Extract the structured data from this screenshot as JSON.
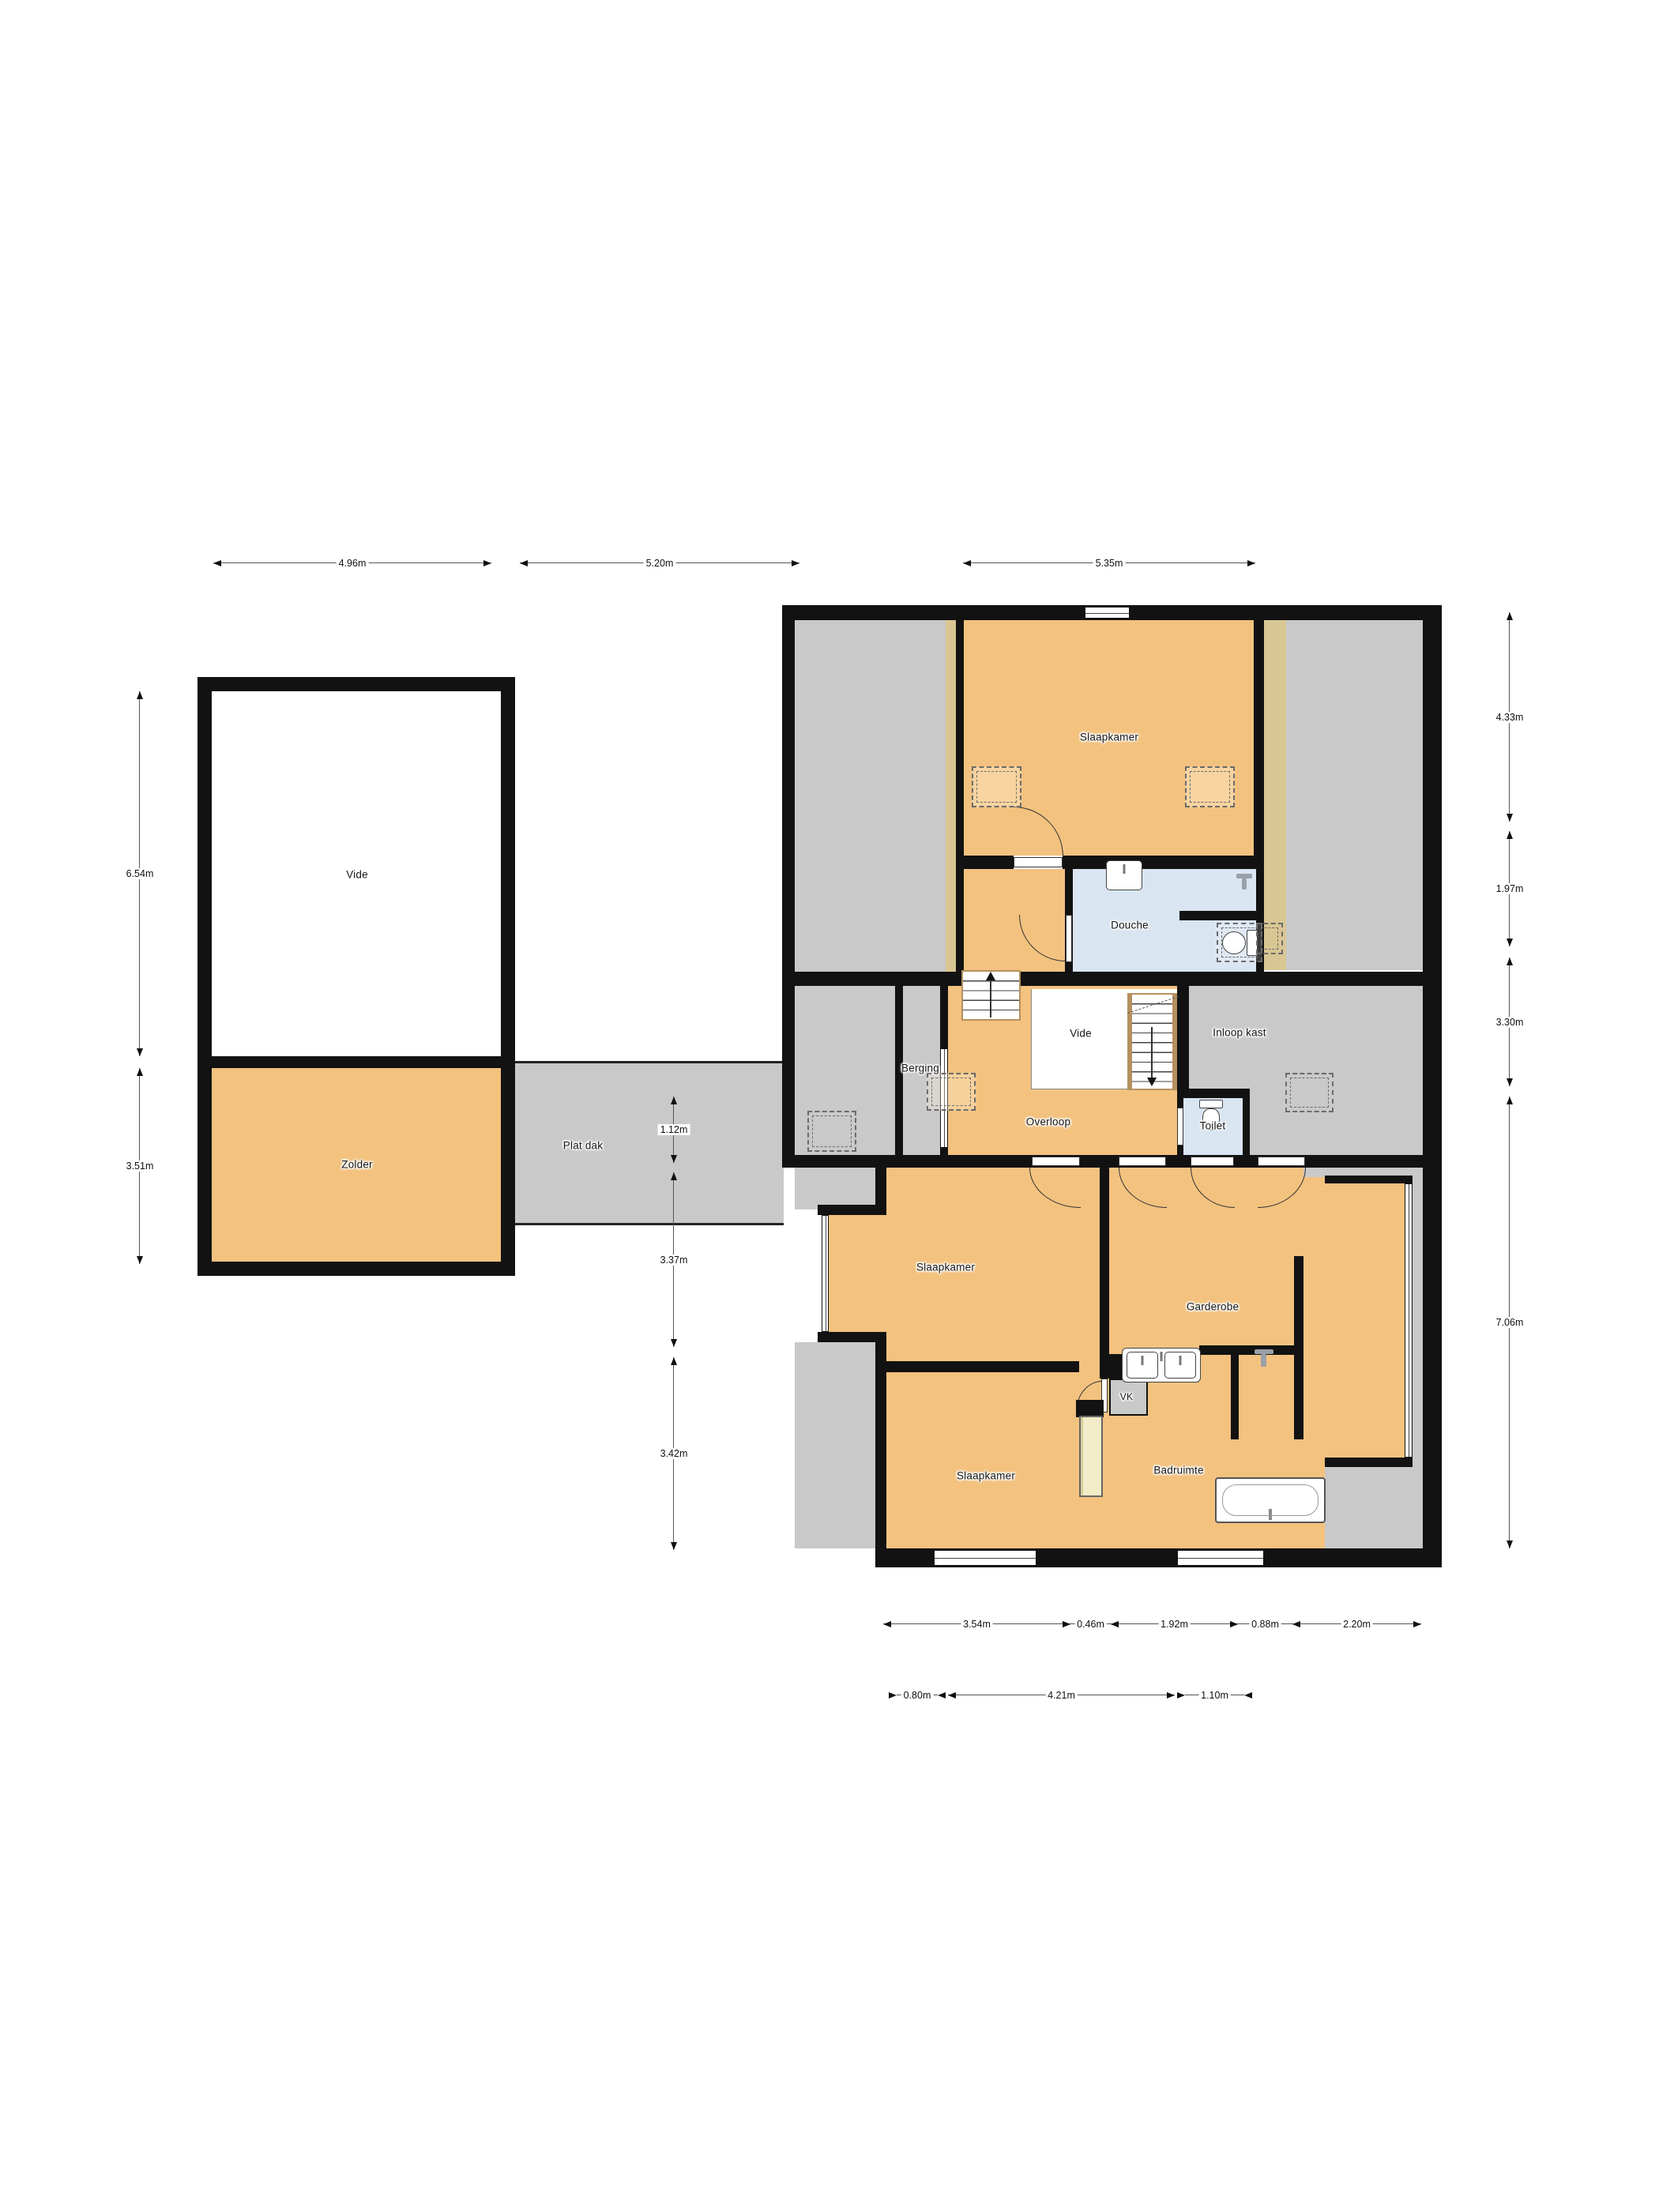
{
  "plan_title": "Floor plan – upper storey",
  "colors": {
    "wall": "#121212",
    "floor_orange": "#F3C27F",
    "floor_gray": "#C9C9C9",
    "floor_tan": "#D9C793",
    "floor_blue": "#D9E5F1",
    "wood": "#B5905F"
  },
  "rooms": {
    "vide_left": {
      "label": "Vide"
    },
    "zolder": {
      "label": "Zolder"
    },
    "plat_dak": {
      "label": "Plat dak"
    },
    "slaapkamer_top": {
      "label": "Slaapkamer"
    },
    "douche": {
      "label": "Douche"
    },
    "berging": {
      "label": "Berging"
    },
    "vide_small": {
      "label": "Vide"
    },
    "overloop": {
      "label": "Overloop"
    },
    "inloop_kast": {
      "label": "Inloop kast"
    },
    "toilet": {
      "label": "Toilet"
    },
    "slaapkamer_mid": {
      "label": "Slaapkamer"
    },
    "garderobe": {
      "label": "Garderobe"
    },
    "vk": {
      "label": "VK"
    },
    "slaapkamer_bottom": {
      "label": "Slaapkamer"
    },
    "badruimte": {
      "label": "Badruimte"
    }
  },
  "dims": {
    "top": [
      {
        "value": "4.96m"
      },
      {
        "value": "5.20m"
      },
      {
        "value": "5.35m"
      }
    ],
    "left": [
      {
        "value": "6.54m"
      },
      {
        "value": "3.51m"
      }
    ],
    "middle": [
      {
        "value": "1.12m"
      },
      {
        "value": "3.37m"
      },
      {
        "value": "3.42m"
      }
    ],
    "right": [
      {
        "value": "4.33m"
      },
      {
        "value": "1.97m"
      },
      {
        "value": "3.30m"
      },
      {
        "value": "7.06m"
      }
    ],
    "bottom_row1": [
      {
        "value": "3.54m"
      },
      {
        "value": "0.46m"
      },
      {
        "value": "1.92m"
      },
      {
        "value": "0.88m"
      },
      {
        "value": "2.20m"
      }
    ],
    "bottom_row2": [
      {
        "value": "0.80m"
      },
      {
        "value": "4.21m"
      },
      {
        "value": "1.10m"
      }
    ]
  },
  "fixtures": [
    "stairs-up",
    "stairs-down",
    "sink",
    "double-sink",
    "toilet",
    "toilet",
    "bathtub",
    "shower-faucet",
    "wardrobe"
  ]
}
